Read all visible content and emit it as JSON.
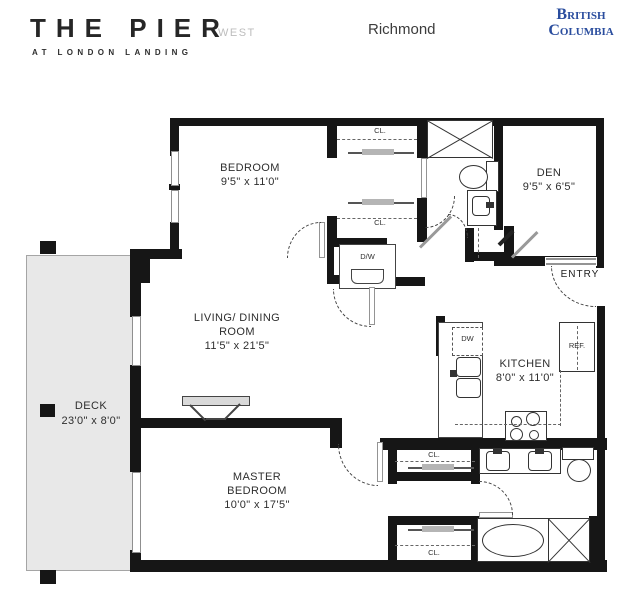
{
  "header": {
    "brand": {
      "title": "THE PIER",
      "subtitle": "AT LONDON LANDING"
    },
    "edition": "WEST",
    "city": "Richmond",
    "province_line1": "British",
    "province_line2": "Columbia",
    "province_color": "#2a4d9e",
    "brand_color": "#262626"
  },
  "floorplan": {
    "rooms": {
      "bedroom": {
        "name": "BEDROOM",
        "dims": "9'5\" x 11'0\""
      },
      "den": {
        "name": "DEN",
        "dims": "9'5\" x 6'5\""
      },
      "living": {
        "name_line1": "LIVING/ DINING",
        "name_line2": "ROOM",
        "dims": "11'5\" x 21'5\""
      },
      "kitchen": {
        "name": "KITCHEN",
        "dims": "8'0\" x 11'0\""
      },
      "master": {
        "name_line1": "MASTER",
        "name_line2": "BEDROOM",
        "dims": "10'0\" x 17'5\""
      },
      "deck": {
        "name": "DECK",
        "dims": "23'0\" x 8'0\""
      },
      "entry": {
        "name": "ENTRY"
      }
    },
    "labels": {
      "closet": "CL.",
      "dishwasher": "DW",
      "refrigerator": "REF.",
      "washer_dryer": "D/W"
    }
  }
}
